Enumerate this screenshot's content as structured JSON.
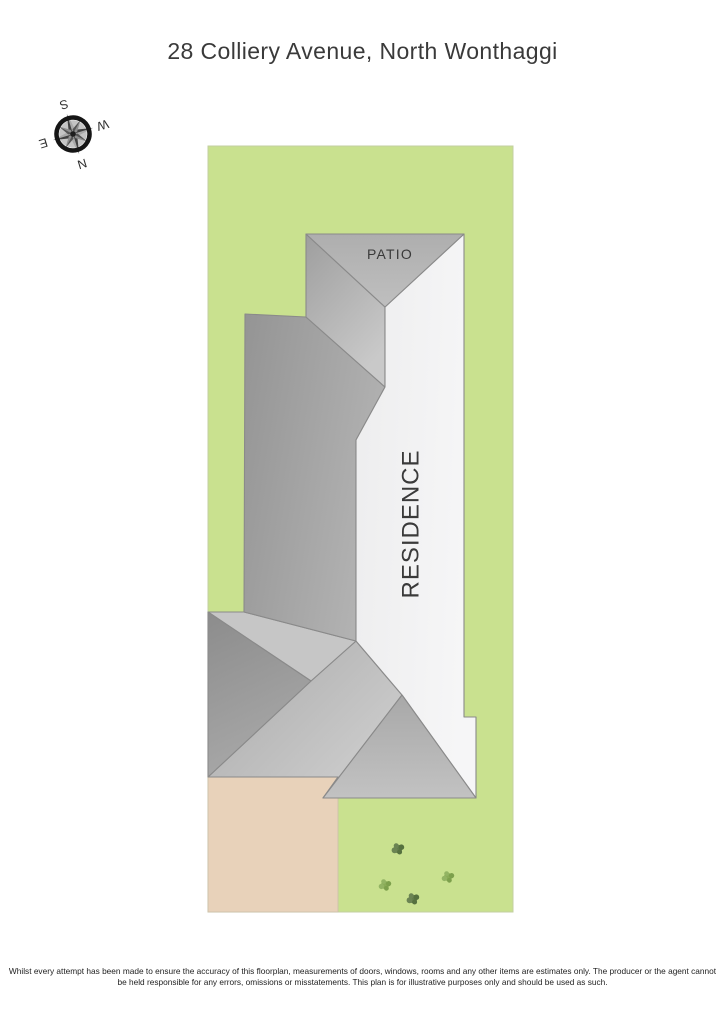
{
  "page": {
    "title": "28 Colliery Avenue, North Wonthaggi"
  },
  "compass": {
    "n": "N",
    "e": "E",
    "s": "S",
    "w": "W",
    "rotation_deg": 163
  },
  "plan": {
    "patio_label": "PATIO",
    "residence_label": "RESIDENCE",
    "shrub_count": 4
  },
  "footer": {
    "line1": "Whilst every attempt has been made to ensure the accuracy of this floorplan, measurements of doors, windows, rooms and any other items are estimates only. The producer or the agent cannot",
    "line2": "be held responsible for any errors, omissions or misstatements. This plan is for illustrative purposes only and should be used as such."
  },
  "colors": {
    "lot_green": "#c9e18f",
    "driveway_tan": "#e8d2ba",
    "roof_white": "#f2f2f3",
    "roof_medium": "#b6b6b6",
    "roof_dark": "#989898",
    "edge_gray": "#8a8a8a",
    "shrub_dark": "#637c4d",
    "shrub_light": "#8aac57",
    "ink": "#3a3a3a"
  }
}
